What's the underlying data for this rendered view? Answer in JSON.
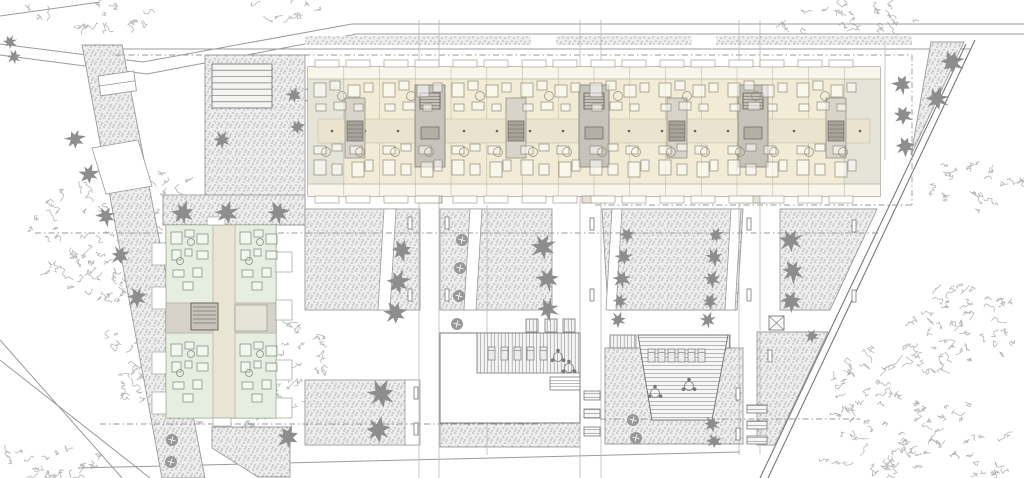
{
  "drawing": {
    "kind": "architectural-site-plan",
    "width": 1024,
    "height": 478,
    "background": "#ffffff"
  },
  "palette": {
    "line": "#9b9b9b",
    "lineDark": "#787878",
    "dash": "#9a9a9a",
    "gridLine": "#b9b9b9",
    "stippleBg": "#ededed",
    "stippleDot": "#8f8f8f",
    "cream": "#f2ecd6",
    "creamBand": "#f7f5ec",
    "creamEdge": "#8d8872",
    "sage": "#e4e5d8",
    "corridorN": "#eae4cf",
    "core": "#c7c3ba",
    "coreEdge": "#8a867c",
    "coreMid": "#d8d4ca",
    "coreDark": "#a8a49a",
    "furnN": "#8f897b",
    "mint": "#dfe9dc",
    "mintEdge": "#7f8a7c",
    "corridorW": "#d6d2c9",
    "furnW": "#78857a",
    "tree": "#8d8d8d",
    "treeDark": "#707070",
    "scribble": "#b6b6b6",
    "white": "#ffffff",
    "poolStripe": "#9a9a9a"
  },
  "roads": {
    "solid": [
      "M0,44 L143,62 L352,24 L1024,24",
      "M0,55 L147,74 L357,34 L1024,34",
      "M0,16 L100,2",
      "M115,49 L970,49",
      "M78,468 L740,452",
      "M0,340 L122,478",
      "M0,360 L150,478",
      "M256,152 Q260,88 340,84",
      "M268,152 Q272,98 342,94",
      "M767,332 L820,332",
      "M767,337 L816,337",
      "M767,332 L767,445"
    ],
    "boundary": [
      "M975,40 L768,478",
      "M966,44 L760,478"
    ],
    "dashed": [
      "M115,55 L912,55",
      "M912,55 L912,205",
      "M595,205 L912,205",
      "M35,233 L880,233",
      "M100,424 L540,424",
      "M600,419 L860,419"
    ]
  },
  "grid_lines": {
    "pairs": [
      [
        419,
        20,
        478
      ],
      [
        439,
        20,
        478
      ],
      [
        580,
        20,
        478
      ],
      [
        601,
        20,
        478
      ],
      [
        739,
        20,
        455
      ],
      [
        760,
        20,
        455
      ]
    ],
    "singles": [
      [
        487,
        205,
        455
      ],
      [
        885,
        45,
        160
      ]
    ]
  },
  "top_band_rects": [
    [
      305,
      36,
      226,
      9
    ],
    [
      556,
      36,
      136,
      9
    ],
    [
      716,
      36,
      196,
      9
    ]
  ],
  "stipple_areas": [
    {
      "name": "west-slope-band",
      "pts": [
        [
          82,
          45
        ],
        [
          122,
          45
        ],
        [
          205,
          478
        ],
        [
          162,
          478
        ]
      ]
    },
    {
      "name": "northwest-terrace",
      "rect": [
        205,
        55,
        100,
        170
      ]
    },
    {
      "name": "west-building-forecourt",
      "rect": [
        163,
        195,
        142,
        30
      ]
    },
    {
      "name": "courtyard-panel-1",
      "rect": [
        305,
        209,
        115,
        101
      ]
    },
    {
      "name": "courtyard-panel-2",
      "rect": [
        440,
        209,
        112,
        101
      ]
    },
    {
      "name": "courtyard-panel-3",
      "pts": [
        [
          602,
          209
        ],
        [
          743,
          209
        ],
        [
          737,
          310
        ],
        [
          608,
          310
        ]
      ]
    },
    {
      "name": "courtyard-panel-4",
      "pts": [
        [
          780,
          209
        ],
        [
          877,
          209
        ],
        [
          830,
          310
        ],
        [
          780,
          310
        ]
      ]
    },
    {
      "name": "south-panel-west",
      "pts": [
        [
          212,
          427
        ],
        [
          290,
          427
        ],
        [
          290,
          477
        ],
        [
          258,
          477
        ],
        [
          212,
          448
        ]
      ]
    },
    {
      "name": "south-panel-center",
      "rect": [
        305,
        380,
        112,
        65
      ]
    },
    {
      "name": "pool-south-strip",
      "rect": [
        440,
        423,
        140,
        24
      ]
    },
    {
      "name": "pool-right-surround",
      "pts": [
        [
          605,
          348
        ],
        [
          743,
          348
        ],
        [
          743,
          444
        ],
        [
          605,
          444
        ]
      ]
    },
    {
      "name": "southeast-panel",
      "pts": [
        [
          757,
          332
        ],
        [
          828,
          332
        ],
        [
          775,
          445
        ],
        [
          757,
          445
        ]
      ]
    },
    {
      "name": "northeast-triangle",
      "pts": [
        [
          931,
          42
        ],
        [
          964,
          42
        ],
        [
          911,
          155
        ]
      ]
    }
  ],
  "white_overlays": [
    {
      "name": "panel1-path",
      "pts": [
        [
          384,
          209
        ],
        [
          396,
          209
        ],
        [
          390,
          310
        ],
        [
          378,
          310
        ]
      ]
    },
    {
      "name": "panel2-path",
      "pts": [
        [
          470,
          209
        ],
        [
          482,
          209
        ],
        [
          476,
          310
        ],
        [
          464,
          310
        ]
      ]
    },
    {
      "name": "panel3-path-left",
      "pts": [
        [
          612,
          209
        ],
        [
          622,
          209
        ],
        [
          616,
          310
        ],
        [
          606,
          310
        ]
      ]
    },
    {
      "name": "panel3-path-right",
      "pts": [
        [
          731,
          209
        ],
        [
          741,
          209
        ],
        [
          735,
          310
        ],
        [
          725,
          310
        ]
      ]
    },
    {
      "name": "south-path",
      "rect": [
        405,
        380,
        15,
        65
      ]
    },
    {
      "name": "west-ramp-pad",
      "pts": [
        [
          92,
          148
        ],
        [
          138,
          140
        ],
        [
          152,
          186
        ],
        [
          106,
          194
        ]
      ]
    }
  ],
  "stair_block": {
    "x": 212,
    "y": 64,
    "w": 60,
    "h": 44,
    "lines": 7
  },
  "ramp": {
    "x": 98,
    "y": 76,
    "w": 36,
    "h": 20,
    "rot": -8
  },
  "benches": [
    [
      408,
      217
    ],
    [
      408,
      289
    ],
    [
      445,
      217
    ],
    [
      445,
      289
    ],
    [
      590,
      218
    ],
    [
      590,
      289
    ],
    [
      747,
      218
    ],
    [
      747,
      289
    ],
    [
      852,
      220
    ],
    [
      852,
      290
    ],
    [
      414,
      387
    ],
    [
      414,
      423
    ],
    [
      736,
      388
    ],
    [
      736,
      428
    ],
    [
      463,
      367
    ],
    [
      768,
      350
    ]
  ],
  "pergolas": [
    [
      526,
      319,
      12,
      13
    ],
    [
      545,
      319,
      12,
      13
    ],
    [
      563,
      319,
      12,
      13
    ],
    [
      610,
      335,
      26,
      13
    ],
    [
      709,
      335,
      21,
      13
    ]
  ],
  "steps_bars": [
    [
      584,
      391,
      16,
      9
    ],
    [
      584,
      409,
      16,
      9
    ],
    [
      584,
      427,
      16,
      9
    ],
    [
      747,
      405,
      20,
      8
    ],
    [
      747,
      421,
      20,
      8
    ],
    [
      747,
      436,
      20,
      8
    ]
  ],
  "box_x": [
    769,
    316,
    15,
    14
  ],
  "north_building": {
    "rect": [
      308,
      67,
      572,
      129
    ],
    "band_line_top": 79,
    "band_line_bottom": 184,
    "end_units": [
      [
        308,
        37
      ],
      [
        843,
        37
      ]
    ],
    "cores": [
      [
        415,
        85,
        30,
        82
      ],
      [
        579,
        85,
        30,
        82
      ],
      [
        738,
        85,
        30,
        82
      ]
    ],
    "mid_cores": [
      [
        345,
        98,
        20,
        60
      ],
      [
        506,
        98,
        20,
        60
      ],
      [
        667,
        98,
        20,
        60
      ],
      [
        826,
        98,
        20,
        60
      ]
    ],
    "corridor": [
      318,
      119,
      552,
      24
    ],
    "divider_step": 35.75,
    "stub_offsets": [
      7,
      38
    ],
    "module_xs": [
      308,
      377,
      446,
      515,
      584,
      653,
      722,
      791
    ],
    "furniture_rects": [
      [
        6,
        83,
        12,
        14
      ],
      [
        22,
        81,
        10,
        9
      ],
      [
        40,
        85,
        12,
        12
      ],
      [
        56,
        83,
        9,
        9
      ],
      [
        8,
        104,
        10,
        7
      ],
      [
        26,
        102,
        12,
        8
      ],
      [
        46,
        104,
        9,
        7
      ],
      [
        6,
        146,
        12,
        8
      ],
      [
        24,
        144,
        10,
        7
      ],
      [
        42,
        146,
        12,
        8
      ],
      [
        6,
        160,
        12,
        15
      ],
      [
        24,
        164,
        10,
        11
      ],
      [
        44,
        162,
        12,
        15
      ],
      [
        57,
        160,
        8,
        11
      ]
    ],
    "furniture_circles": [
      [
        34,
        96
      ],
      [
        18,
        152
      ],
      [
        52,
        152
      ]
    ]
  },
  "west_building": {
    "body": [
      166,
      225,
      110,
      193
    ],
    "corridor": [
      213,
      225,
      22,
      193
    ],
    "mid_band": [
      166,
      303,
      110,
      30
    ],
    "core": [
      191,
      303,
      27,
      27
    ],
    "wing": [
      235,
      305,
      32,
      26
    ],
    "units": [
      [
        166,
        225,
        47,
        78
      ],
      [
        235,
        225,
        41,
        78
      ],
      [
        166,
        333,
        47,
        85
      ],
      [
        235,
        333,
        41,
        85
      ]
    ],
    "stubs_left": [
      [
        152,
        243
      ],
      [
        152,
        287
      ],
      [
        152,
        352
      ],
      [
        152,
        392
      ]
    ],
    "stubs_right": [
      [
        276,
        252
      ],
      [
        276,
        300
      ],
      [
        276,
        360
      ],
      [
        276,
        398
      ]
    ],
    "stub_top": [
      207,
      217,
      18,
      8
    ],
    "stub_bottom": [
      213,
      418,
      18,
      8
    ],
    "furn_quads": [
      [
        169,
        228
      ],
      [
        238,
        228
      ],
      [
        169,
        340
      ],
      [
        238,
        340
      ]
    ],
    "furniture_rects": [
      [
        2,
        4,
        11,
        12
      ],
      [
        16,
        2,
        9,
        7
      ],
      [
        28,
        6,
        11,
        10
      ],
      [
        3,
        22,
        9,
        10
      ],
      [
        16,
        21,
        7,
        7
      ],
      [
        28,
        23,
        11,
        8
      ],
      [
        4,
        42,
        11,
        7
      ],
      [
        24,
        40,
        9,
        9
      ],
      [
        14,
        54,
        10,
        8
      ]
    ],
    "furniture_circles": [
      [
        22,
        14
      ],
      [
        11,
        33
      ]
    ]
  },
  "pool_left": {
    "deck": [
      440,
      333,
      140,
      90
    ],
    "band": [
      477,
      333,
      103,
      40
    ],
    "steps": [
      550,
      377,
      30,
      13
    ],
    "loungers": {
      "x0": 488,
      "y": 347,
      "n": 5,
      "dx": 13
    },
    "tables": [
      [
        558,
        357
      ],
      [
        569,
        368
      ]
    ]
  },
  "pool_right": {
    "pool": [
      [
        638,
        335
      ],
      [
        728,
        335
      ],
      [
        712,
        420
      ],
      [
        652,
        420
      ]
    ],
    "loungers": {
      "x0": 648,
      "y": 349,
      "n": 6,
      "dx": 10
    },
    "tables": [
      [
        655,
        393
      ],
      [
        689,
        386
      ]
    ]
  },
  "trees": {
    "star": [
      [
        75,
        139,
        10
      ],
      [
        89,
        174,
        10
      ],
      [
        106,
        216,
        10
      ],
      [
        120,
        255,
        10
      ],
      [
        137,
        297,
        11
      ],
      [
        10,
        42,
        7
      ],
      [
        14,
        57,
        7
      ],
      [
        294,
        95,
        8
      ],
      [
        297,
        127,
        8
      ],
      [
        222,
        140,
        9
      ],
      [
        183,
        213,
        12
      ],
      [
        227,
        213,
        12
      ],
      [
        278,
        213,
        12
      ],
      [
        402,
        250,
        11
      ],
      [
        398,
        282,
        12
      ],
      [
        395,
        313,
        12
      ],
      [
        543,
        247,
        13
      ],
      [
        548,
        279,
        12
      ],
      [
        548,
        309,
        11
      ],
      [
        627,
        235,
        8
      ],
      [
        624,
        257,
        9
      ],
      [
        622,
        279,
        9
      ],
      [
        620,
        301,
        8
      ],
      [
        618,
        320,
        8
      ],
      [
        716,
        235,
        8
      ],
      [
        714,
        257,
        9
      ],
      [
        712,
        279,
        9
      ],
      [
        710,
        301,
        8
      ],
      [
        708,
        320,
        8
      ],
      [
        791,
        240,
        12
      ],
      [
        793,
        271,
        12
      ],
      [
        791,
        301,
        11
      ],
      [
        902,
        84,
        10
      ],
      [
        903,
        115,
        10
      ],
      [
        905,
        146,
        10
      ],
      [
        952,
        62,
        12
      ],
      [
        937,
        99,
        12
      ],
      [
        381,
        394,
        14
      ],
      [
        378,
        430,
        13
      ],
      [
        288,
        437,
        12
      ],
      [
        712,
        424,
        8
      ],
      [
        714,
        441,
        8
      ],
      [
        812,
        336,
        7
      ]
    ],
    "circle": [
      [
        462,
        240,
        6
      ],
      [
        460,
        268,
        6
      ],
      [
        459,
        296,
        6
      ],
      [
        457,
        324,
        6
      ],
      [
        172,
        440,
        6
      ],
      [
        171,
        462,
        6
      ],
      [
        633,
        420,
        6
      ],
      [
        636,
        438,
        6
      ]
    ]
  },
  "scribble_clusters": [
    [
      85,
      14,
      66,
      16
    ],
    [
      287,
      8,
      46,
      11
    ],
    [
      840,
      18,
      74,
      21
    ],
    [
      125,
      235,
      95,
      70
    ],
    [
      215,
      358,
      115,
      72
    ],
    [
      50,
      464,
      58,
      24
    ],
    [
      975,
      185,
      52,
      26
    ],
    [
      963,
      322,
      56,
      46
    ],
    [
      895,
      400,
      72,
      60
    ],
    [
      988,
      453,
      34,
      26
    ],
    [
      868,
      466,
      48,
      14
    ]
  ]
}
